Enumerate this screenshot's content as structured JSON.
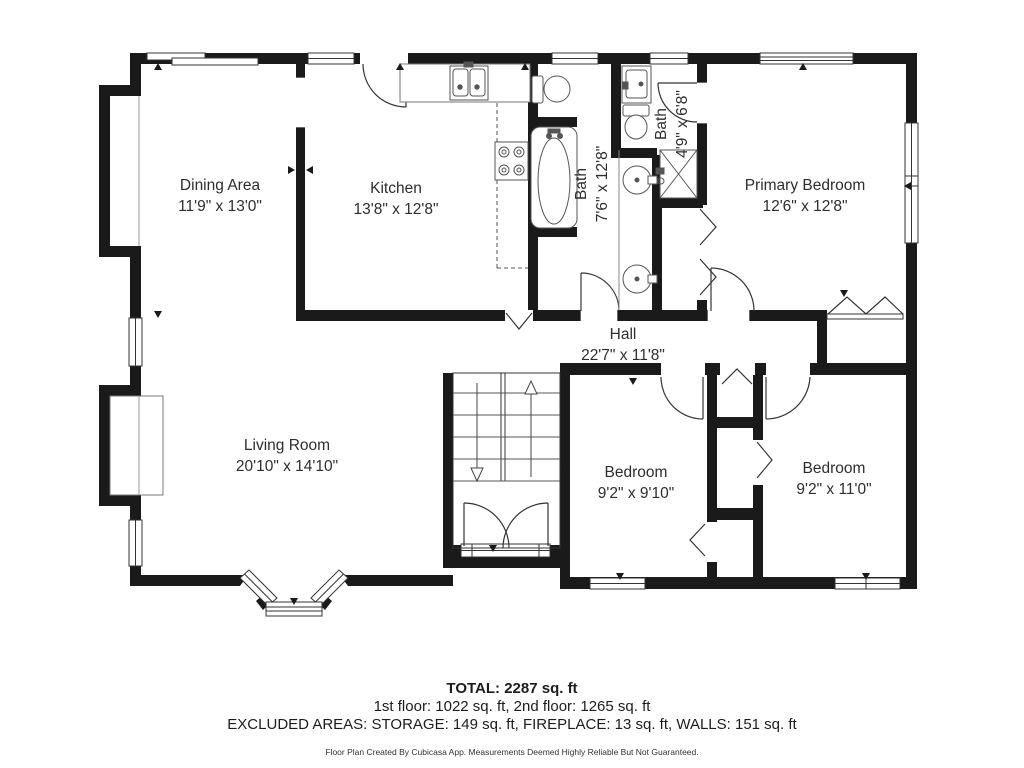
{
  "rooms": [
    {
      "id": "dining",
      "name": "Dining Area",
      "dims": "11'9\" x 13'0\""
    },
    {
      "id": "kitchen",
      "name": "Kitchen",
      "dims": "13'8\" x 12'8\""
    },
    {
      "id": "bath",
      "name": "Bath",
      "dims": "7'6\" x 12'8\""
    },
    {
      "id": "bath-small",
      "name": "Bath",
      "dims": "4'9\" x 6'8\""
    },
    {
      "id": "primary-bedroom",
      "name": "Primary Bedroom",
      "dims": "12'6\" x 12'8\""
    },
    {
      "id": "hall",
      "name": "Hall",
      "dims": "22'7\" x 11'8\""
    },
    {
      "id": "living-room",
      "name": "Living Room",
      "dims": "20'10\" x 14'10\""
    },
    {
      "id": "bedroom-middle",
      "name": "Bedroom",
      "dims": "9'2\" x 9'10\""
    },
    {
      "id": "bedroom-right",
      "name": "Bedroom",
      "dims": "9'2\" x 11'0\""
    }
  ],
  "summary": {
    "total": "TOTAL: 2287 sq. ft",
    "floors": "1st floor: 1022 sq. ft, 2nd floor: 1265 sq. ft",
    "excluded": "EXCLUDED AREAS: STORAGE: 149 sq. ft, FIREPLACE: 13 sq. ft, WALLS: 151 sq. ft",
    "disclaimer": "Floor Plan Created By Cubicasa App. Measurements Deemed Highly Reliable But Not Guaranteed."
  },
  "fixtures": [
    "stairs",
    "entry-double-door",
    "bathtub",
    "toilet",
    "double-vanity-sinks",
    "shower",
    "kitchen-sink",
    "stove",
    "fireplace",
    "bay-window",
    "closet-bifold-doors"
  ],
  "colors": {
    "wall": "#1a1a1a",
    "background": "#ffffff",
    "thin_line": "#444444",
    "text": "#2d2d2d"
  }
}
